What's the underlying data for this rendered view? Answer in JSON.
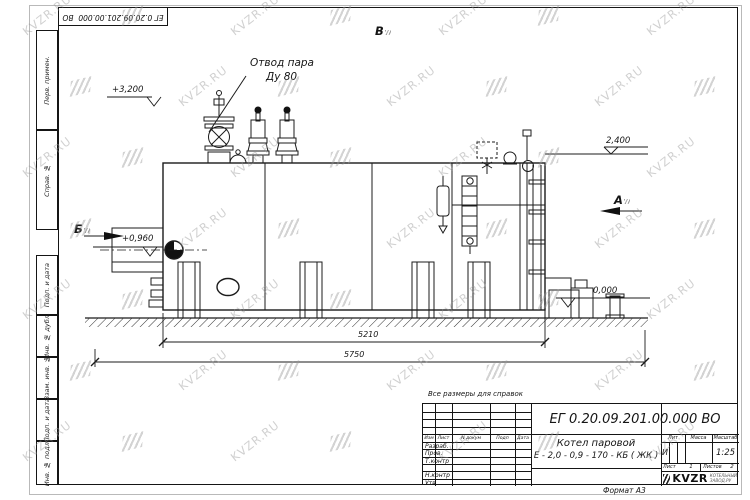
{
  "watermark": {
    "text": "KVZR.RU"
  },
  "sheet": {
    "inverted_designation": "ЕГ 0.20.09.201.00.000  ВО",
    "note": "Все размеры для справок",
    "format_label": "Формат А3"
  },
  "side_columns": {
    "perv_primen": "Перв. примен.",
    "sprav_no": "Справ. №",
    "podp_data_1": "Подп. и дата",
    "inv_dubl": "Инв. № дубл.",
    "vzam_inv": "Взам. инв. №",
    "podp_data_2": "Подп. и дата",
    "inv_podl": "Инв. № подл."
  },
  "drawing": {
    "callout": {
      "line1": "Отвод пара",
      "line2": "Ду 80"
    },
    "elevations": {
      "top": "+3,200",
      "boiler_top": "2,400",
      "burner_axis": "+0,960",
      "ground": "0,000"
    },
    "views": {
      "a": "А",
      "b": "Б",
      "v": "В"
    },
    "dimensions": {
      "body_length": "5210",
      "overall_length": "5750"
    }
  },
  "title_block": {
    "designation": "ЕГ 0.20.09.201.00.000  ВО",
    "product_line1": "Котел паровой",
    "product_line2": "Е - 2,0 - 0,9 - 170 - КБ ( ЖК )",
    "header": {
      "izm": "Изм",
      "list": "Лист",
      "doc": "N докум",
      "podp": "Подп",
      "date": "Дата"
    },
    "rows": [
      "Разраб.",
      "Пров.",
      "Т.контр",
      "",
      "Н.контр",
      "Утв."
    ],
    "lit_label": "Лит",
    "massa_label": "Масса",
    "scale_label": "Масштаб",
    "lit_value": "И",
    "scale_value": "1:25",
    "sheet_label": "Лист",
    "sheet_value": "1",
    "sheets_label": "Листов",
    "sheets_value": "2",
    "logo": {
      "name": "KVZR",
      "sub1": "КОТЕЛЬНЫЙ",
      "sub2": "ЗАВОД.РУ"
    }
  }
}
